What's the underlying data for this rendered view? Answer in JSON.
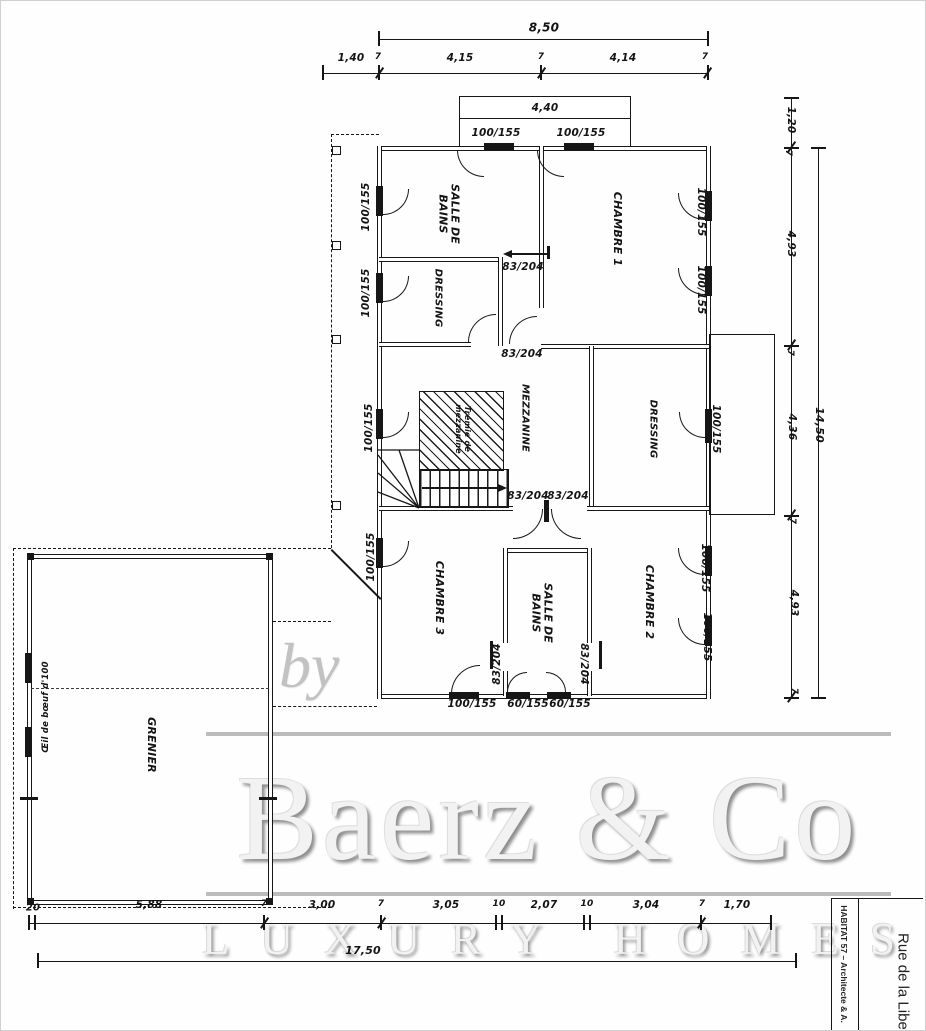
{
  "colors": {
    "ink": "#161616",
    "paper": "#fefefe",
    "watermark_gray": "#c2c2c2"
  },
  "watermark": {
    "by": "by",
    "brand": "Baerz & Co",
    "tagline": "LUXURY HOMES"
  },
  "title_block": {
    "firm": "HABITAT 57 – Architecte & A.",
    "street": "Rue de la Libert"
  },
  "plan": {
    "rooms": [
      {
        "t": "SALLE DE\nBAINS",
        "x": 447,
        "y": 213,
        "r": 90,
        "s": 11,
        "n": "room-label-salle-de-bains-1"
      },
      {
        "t": "CHAMBRE 1",
        "x": 616,
        "y": 228,
        "r": 90,
        "s": 11,
        "n": "room-label-chambre-1"
      },
      {
        "t": "DRESSING",
        "x": 437,
        "y": 297,
        "r": 90,
        "s": 10,
        "n": "room-label-dressing-1"
      },
      {
        "t": "MEZZANINE",
        "x": 524,
        "y": 417,
        "r": 90,
        "s": 10,
        "n": "room-label-mezzanine"
      },
      {
        "t": "DRESSING",
        "x": 652,
        "y": 428,
        "r": 90,
        "s": 10,
        "n": "room-label-dressing-2"
      },
      {
        "t": "Trémie de\nmezzanine",
        "x": 461,
        "y": 428,
        "r": 90,
        "s": 8,
        "n": "tremie-note"
      },
      {
        "t": "CHAMBRE 3",
        "x": 438,
        "y": 597,
        "r": 90,
        "s": 11,
        "n": "room-label-chambre-3"
      },
      {
        "t": "SALLE DE\nBAINS",
        "x": 540,
        "y": 612,
        "r": 90,
        "s": 11,
        "n": "room-label-salle-de-bains-2"
      },
      {
        "t": "CHAMBRE 2",
        "x": 648,
        "y": 601,
        "r": 90,
        "s": 11,
        "n": "room-label-chambre-2"
      },
      {
        "t": "GRENIER",
        "x": 150,
        "y": 744,
        "r": 90,
        "s": 11,
        "n": "room-label-grenier"
      },
      {
        "t": "Œil de bœuf d'100",
        "x": 46,
        "y": 706,
        "r": -90,
        "s": 8.5,
        "n": "oeil-de-boeuf-note"
      }
    ],
    "size_labels": [
      {
        "t": "100/155",
        "x": 495,
        "y": 133,
        "r": 0
      },
      {
        "t": "100/155",
        "x": 580,
        "y": 133,
        "r": 0
      },
      {
        "t": "100/155",
        "x": 366,
        "y": 206,
        "r": -90
      },
      {
        "t": "100/155",
        "x": 366,
        "y": 292,
        "r": -90
      },
      {
        "t": "100/155",
        "x": 369,
        "y": 427,
        "r": -90
      },
      {
        "t": "100/155",
        "x": 371,
        "y": 556,
        "r": -90
      },
      {
        "t": "100/155",
        "x": 699,
        "y": 211,
        "r": 90
      },
      {
        "t": "100/155",
        "x": 699,
        "y": 289,
        "r": 90
      },
      {
        "t": "100/155",
        "x": 714,
        "y": 428,
        "r": 90
      },
      {
        "t": "100/155",
        "x": 703,
        "y": 567,
        "r": 90
      },
      {
        "t": "100/155",
        "x": 705,
        "y": 636,
        "r": 90
      },
      {
        "t": "100/155",
        "x": 471,
        "y": 704,
        "r": 0
      },
      {
        "t": "60/155",
        "x": 527,
        "y": 704,
        "r": 0
      },
      {
        "t": "60/155",
        "x": 569,
        "y": 704,
        "r": 0
      },
      {
        "t": "83/204",
        "x": 522,
        "y": 267,
        "r": 0
      },
      {
        "t": "83/204",
        "x": 521,
        "y": 354,
        "r": 0
      },
      {
        "t": "83/204",
        "x": 527,
        "y": 496,
        "r": 0
      },
      {
        "t": "83/204",
        "x": 567,
        "y": 496,
        "r": 0
      },
      {
        "t": "83/204",
        "x": 497,
        "y": 663,
        "r": -90
      },
      {
        "t": "83/204",
        "x": 582,
        "y": 663,
        "r": 90
      }
    ]
  },
  "dimensions": {
    "labels": [
      {
        "t": "8,50",
        "x": 543,
        "y": 27,
        "s": 12
      },
      {
        "t": "1,40",
        "x": 350,
        "y": 58
      },
      {
        "t": "7",
        "x": 377,
        "y": 56,
        "s": 9
      },
      {
        "t": "4,15",
        "x": 459,
        "y": 58
      },
      {
        "t": "7",
        "x": 540,
        "y": 56,
        "s": 9
      },
      {
        "t": "4,14",
        "x": 622,
        "y": 58
      },
      {
        "t": "7",
        "x": 704,
        "y": 56,
        "s": 9
      },
      {
        "t": "4,40",
        "x": 544,
        "y": 108
      },
      {
        "t": "1,20",
        "x": 789,
        "y": 119,
        "r": 90
      },
      {
        "t": "7",
        "x": 787,
        "y": 152,
        "r": 90,
        "s": 9
      },
      {
        "t": "4,93",
        "x": 789,
        "y": 243,
        "r": 90
      },
      {
        "t": "7",
        "x": 789,
        "y": 352,
        "r": 90,
        "s": 9
      },
      {
        "t": "4,36",
        "x": 790,
        "y": 426,
        "r": 90
      },
      {
        "t": "7",
        "x": 791,
        "y": 520,
        "r": 90,
        "s": 9
      },
      {
        "t": "4,93",
        "x": 792,
        "y": 602,
        "r": 90
      },
      {
        "t": "7",
        "x": 793,
        "y": 690,
        "r": 90,
        "s": 9
      },
      {
        "t": "14,50",
        "x": 818,
        "y": 424,
        "r": 90,
        "s": 11
      },
      {
        "t": "20",
        "x": 32,
        "y": 907,
        "s": 10
      },
      {
        "t": "5,88",
        "x": 148,
        "y": 905
      },
      {
        "t": "7",
        "x": 263,
        "y": 903,
        "s": 9
      },
      {
        "t": "3,00",
        "x": 321,
        "y": 905
      },
      {
        "t": "7",
        "x": 380,
        "y": 903,
        "s": 9
      },
      {
        "t": "3,05",
        "x": 445,
        "y": 905
      },
      {
        "t": "10",
        "x": 498,
        "y": 903,
        "s": 9
      },
      {
        "t": "2,07",
        "x": 543,
        "y": 905
      },
      {
        "t": "10",
        "x": 586,
        "y": 903,
        "s": 9
      },
      {
        "t": "3,04",
        "x": 645,
        "y": 905
      },
      {
        "t": "7",
        "x": 701,
        "y": 903,
        "s": 9
      },
      {
        "t": "1,70",
        "x": 736,
        "y": 905
      },
      {
        "t": "17,50",
        "x": 362,
        "y": 950,
        "s": 11
      }
    ]
  }
}
